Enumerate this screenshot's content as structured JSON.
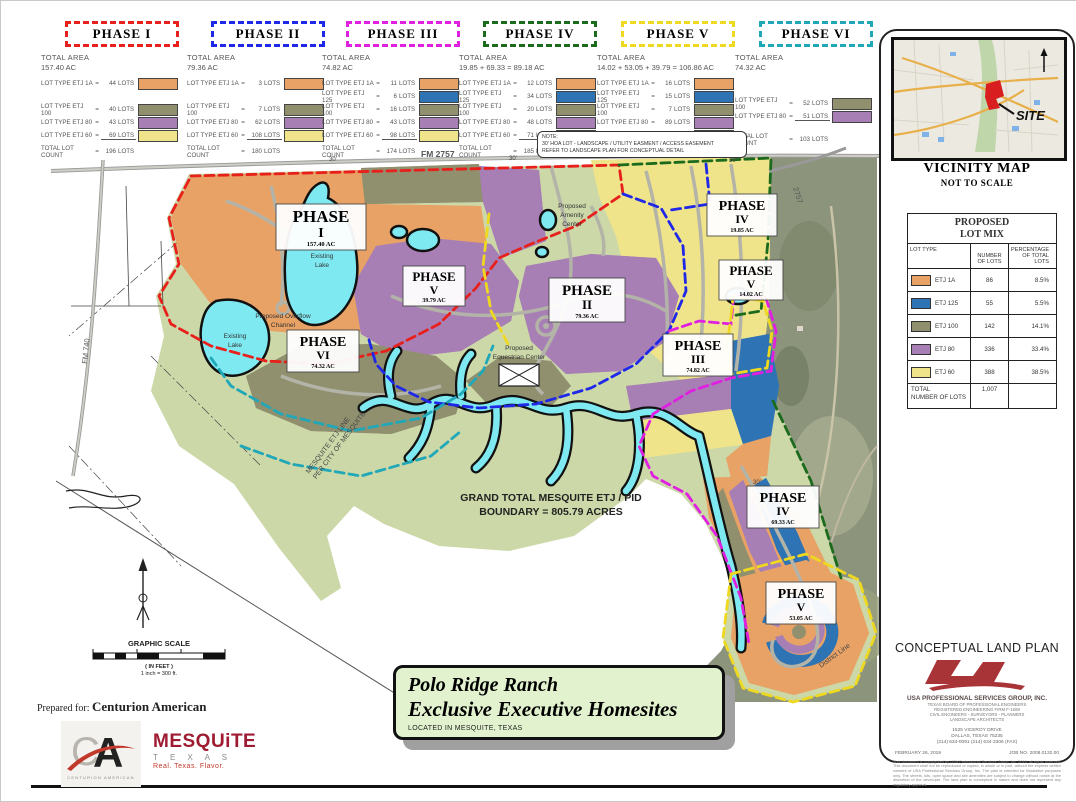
{
  "legend_labels": {
    "total_area": "TOTAL AREA"
  },
  "phases": [
    {
      "title": "PHASE I",
      "border": "#E8201C",
      "area": "157.40 AC",
      "rows": [
        {
          "label": "LOT TYPE ETJ 1A",
          "eq": "=",
          "count": "44",
          "unit": "LOTS",
          "color": "#E8A265"
        },
        {
          "label": "LOT TYPE ETJ 100",
          "eq": "=",
          "count": "40",
          "unit": "LOTS",
          "color": "#90906F"
        },
        {
          "label": "LOT TYPE ETJ 80",
          "eq": "=",
          "count": "43",
          "unit": "LOTS",
          "color": "#A77FB5"
        },
        {
          "label": "LOT TYPE ETJ 60",
          "eq": "=",
          "count": "69",
          "unit": "LOTS",
          "color": "#EFE48A"
        }
      ],
      "total_label": "TOTAL LOT COUNT",
      "total_eq": "=",
      "total": "196",
      "total_unit": "LOTS"
    },
    {
      "title": "PHASE II",
      "border": "#2028E8",
      "area": "79.36 AC",
      "rows": [
        {
          "label": "LOT TYPE ETJ 1A",
          "eq": "=",
          "count": "3",
          "unit": "LOTS",
          "color": "#E8A265"
        },
        {
          "label": "LOT TYPE ETJ 100",
          "eq": "=",
          "count": "7",
          "unit": "LOTS",
          "color": "#90906F"
        },
        {
          "label": "LOT TYPE ETJ 80",
          "eq": "=",
          "count": "62",
          "unit": "LOTS",
          "color": "#A77FB5"
        },
        {
          "label": "LOT TYPE ETJ 60",
          "eq": "=",
          "count": "108",
          "unit": "LOTS",
          "color": "#EFE48A"
        }
      ],
      "total_label": "TOTAL LOT COUNT",
      "total_eq": "=",
      "total": "180",
      "total_unit": "LOTS"
    },
    {
      "title": "PHASE III",
      "border": "#E020E0",
      "area": "74.82 AC",
      "rows": [
        {
          "label": "LOT TYPE ETJ 1A",
          "eq": "=",
          "count": "11",
          "unit": "LOTS",
          "color": "#E8A265"
        },
        {
          "label": "LOT TYPE ETJ 125",
          "eq": "=",
          "count": "6",
          "unit": "LOTS",
          "color": "#2E74B5"
        },
        {
          "label": "LOT TYPE ETJ 100",
          "eq": "=",
          "count": "16",
          "unit": "LOTS",
          "color": "#90906F"
        },
        {
          "label": "LOT TYPE ETJ 80",
          "eq": "=",
          "count": "43",
          "unit": "LOTS",
          "color": "#A77FB5"
        },
        {
          "label": "LOT TYPE ETJ 60",
          "eq": "=",
          "count": "98",
          "unit": "LOTS",
          "color": "#EFE48A"
        }
      ],
      "total_label": "TOTAL LOT COUNT",
      "total_eq": "=",
      "total": "174",
      "total_unit": "LOTS"
    },
    {
      "title": "PHASE IV",
      "border": "#1C6B1C",
      "area": "19.85 + 69.33 = 89.18 AC",
      "rows": [
        {
          "label": "LOT TYPE ETJ 1A",
          "eq": "=",
          "count": "12",
          "unit": "LOTS",
          "color": "#E8A265"
        },
        {
          "label": "LOT TYPE ETJ 125",
          "eq": "=",
          "count": "34",
          "unit": "LOTS",
          "color": "#2E74B5"
        },
        {
          "label": "LOT TYPE ETJ 100",
          "eq": "=",
          "count": "20",
          "unit": "LOTS",
          "color": "#90906F"
        },
        {
          "label": "LOT TYPE ETJ 80",
          "eq": "=",
          "count": "48",
          "unit": "LOTS",
          "color": "#A77FB5"
        },
        {
          "label": "LOT TYPE ETJ 60",
          "eq": "=",
          "count": "71",
          "unit": "LOTS",
          "color": "#EFE48A"
        }
      ],
      "total_label": "TOTAL LOT COUNT",
      "total_eq": "=",
      "total": "185",
      "total_unit": "LOTS"
    },
    {
      "title": "PHASE V",
      "border": "#EFD820",
      "area": "14.02 + 53.05 + 39.79 = 106.86 AC",
      "rows": [
        {
          "label": "LOT TYPE ETJ 1A",
          "eq": "=",
          "count": "16",
          "unit": "LOTS",
          "color": "#E8A265"
        },
        {
          "label": "LOT TYPE ETJ 125",
          "eq": "=",
          "count": "15",
          "unit": "LOTS",
          "color": "#2E74B5"
        },
        {
          "label": "LOT TYPE ETJ 100",
          "eq": "=",
          "count": "7",
          "unit": "LOTS",
          "color": "#90906F"
        },
        {
          "label": "LOT TYPE ETJ 80",
          "eq": "=",
          "count": "89",
          "unit": "LOTS",
          "color": "#A77FB5"
        },
        {
          "label": "LOT TYPE ETJ 60",
          "eq": "=",
          "count": "42",
          "unit": "LOTS",
          "color": "#EFE48A"
        }
      ],
      "total_label": "TOTAL LOT COUNT",
      "total_eq": "=",
      "total": "169",
      "total_unit": "LOTS"
    },
    {
      "title": "PHASE VI",
      "border": "#20A8B8",
      "area": "74.32 AC",
      "rows": [
        {
          "label": "LOT TYPE ETJ 100",
          "eq": "=",
          "count": "52",
          "unit": "LOTS",
          "color": "#90906F"
        },
        {
          "label": "LOT TYPE ETJ 80",
          "eq": "=",
          "count": "51",
          "unit": "LOTS",
          "color": "#A77FB5"
        }
      ],
      "total_label": "TOTAL LOT COUNT",
      "total_eq": "=",
      "total": "103",
      "total_unit": "LOTS"
    }
  ],
  "note": {
    "l1": "NOTE:",
    "l2": "30' HOA LOT - LANDSCAPE / UTILITY EASMENT / ACCESS EASEMENT",
    "l3": "REFER TO LANDSCAPE PLAN FOR CONCEPTUAL DETAIL"
  },
  "vicinity": {
    "title": "VICINITY MAP",
    "subtitle": "NOT TO SCALE",
    "site": "SITE",
    "north": "N"
  },
  "lot_mix": {
    "title_1": "PROPOSED",
    "title_2": "LOT MIX",
    "h_type": "LOT TYPE",
    "h_num_1": "NUMBER",
    "h_num_2": "OF LOTS",
    "h_pct_1": "PERCENTAGE",
    "h_pct_2": "OF TOTAL LOTS",
    "rows": [
      {
        "type": "ETJ 1A",
        "color": "#E8A265",
        "num": "86",
        "pct": "8.5%"
      },
      {
        "type": "ETJ 125",
        "color": "#2E74B5",
        "num": "55",
        "pct": "5.5%"
      },
      {
        "type": "ETJ 100",
        "color": "#90906F",
        "num": "142",
        "pct": "14.1%"
      },
      {
        "type": "ETJ 80",
        "color": "#A77FB5",
        "num": "336",
        "pct": "33.4%"
      },
      {
        "type": "ETJ 60",
        "color": "#EFE48A",
        "num": "388",
        "pct": "38.5%"
      }
    ],
    "total_label_1": "TOTAL",
    "total_label_2": "NUMBER OF LOTS",
    "total": "1,007"
  },
  "map": {
    "labels": [
      {
        "phase": "PHASE",
        "num": "I",
        "area": "157.40 AC"
      },
      {
        "phase": "PHASE",
        "num": "V",
        "area": "39.79 AC"
      },
      {
        "phase": "PHASE",
        "num": "II",
        "area": "79.36 AC"
      },
      {
        "phase": "PHASE",
        "num": "IV",
        "area": "19.85 AC"
      },
      {
        "phase": "PHASE",
        "num": "V",
        "area": "14.02 AC"
      },
      {
        "phase": "PHASE",
        "num": "III",
        "area": "74.82 AC"
      },
      {
        "phase": "PHASE",
        "num": "VI",
        "area": "74.32 AC"
      },
      {
        "phase": "PHASE",
        "num": "IV",
        "area": "69.33 AC"
      },
      {
        "phase": "PHASE",
        "num": "V",
        "area": "53.05 AC"
      }
    ],
    "texts": {
      "fm2757": "FM 2757",
      "r2757": "2757",
      "fm740": "FM 740",
      "lake_1": "Existing",
      "lake_2": "Lake",
      "overflow_1": "Proposed Overflow",
      "overflow_2": "Channel",
      "amenity_1": "Proposed",
      "amenity_2": "Amenity",
      "amenity_3": "Center",
      "eq_1": "Proposed",
      "eq_2": "Equestrian Center",
      "grand_1": "GRAND TOTAL MESQUITE ETJ / PID",
      "grand_2": "BOUNDARY = 805.79 ACRES",
      "etj_1": "MESQUITE ETJ LINE",
      "etj_2": "PER CITY OF MESQUITE",
      "district": "District Line",
      "dim30": "30'"
    }
  },
  "scalebar": {
    "title": "GRAPHIC SCALE",
    "unit": "( IN FEET )",
    "ratio": "1 inch = 300 ft."
  },
  "title_block": {
    "line1": "Polo Ridge Ranch",
    "line2": "Exclusive Executive Homesites",
    "location": "LOCATED IN MESQUITE, TEXAS"
  },
  "prepared": {
    "label": "Prepared for:",
    "name": "Centurion American"
  },
  "logos": {
    "ca_mono": "CA",
    "ca_sub": "CENTURION AMERICAN",
    "mesquite": "MESQUiTE",
    "mesquite_state": "T E X A S",
    "mesquite_tag": "Real. Texas. Flavor."
  },
  "firm": {
    "plan_title": "CONCEPTUAL LAND PLAN",
    "name": "USA PROFESSIONAL SERVICES GROUP, INC.",
    "line1": "TEXAS BOARD OF PROFESSIONAL ENGINEERS",
    "line2": "REGISTERED ENGINEERING FIRM F-1588",
    "line3": "CIVIL ENGINEERS - SURVEYORS - PLANNERS",
    "line4": "LANDSCAPE ARCHITECTS",
    "addr1": "1525 VICEROY DRIVE",
    "addr2": "DALLAS, TEXAS 75235",
    "addr3": "(214) 634-0091    (214) 634-3306 (FAX)",
    "date": "FEBRUARY 26, 2019",
    "job": "JOB NO. 2008.0132.00",
    "disclaimer": "This document is copyrighted by USA Professional Services Group, Inc. 2019, all rights reserved. This document shall not be reproduced or copied, in whole or in part, without the express written consent of USA Professional Services Group, Inc. The plan is intended for illustrative purposes only. The streets, lots, open space and site amenities are subject to change without notice at the discretion of the developer. The land plan is conceptual in nature and does not represent any regulatory approval."
  },
  "colors": {
    "orange": "#E8A265",
    "blue": "#2E74B5",
    "olive": "#90906F",
    "purple": "#A77FB5",
    "yellow": "#EFE48A",
    "water": "#7FE9F2",
    "site_green": "#CCD8A8",
    "aerial": "#8D947C",
    "red_boundary": "#E8201C",
    "blue_boundary": "#2028E8",
    "magenta_boundary": "#E020E0",
    "green_boundary": "#1C6B1C",
    "yellow_boundary": "#EFD820",
    "teal_boundary": "#20A8B8"
  }
}
